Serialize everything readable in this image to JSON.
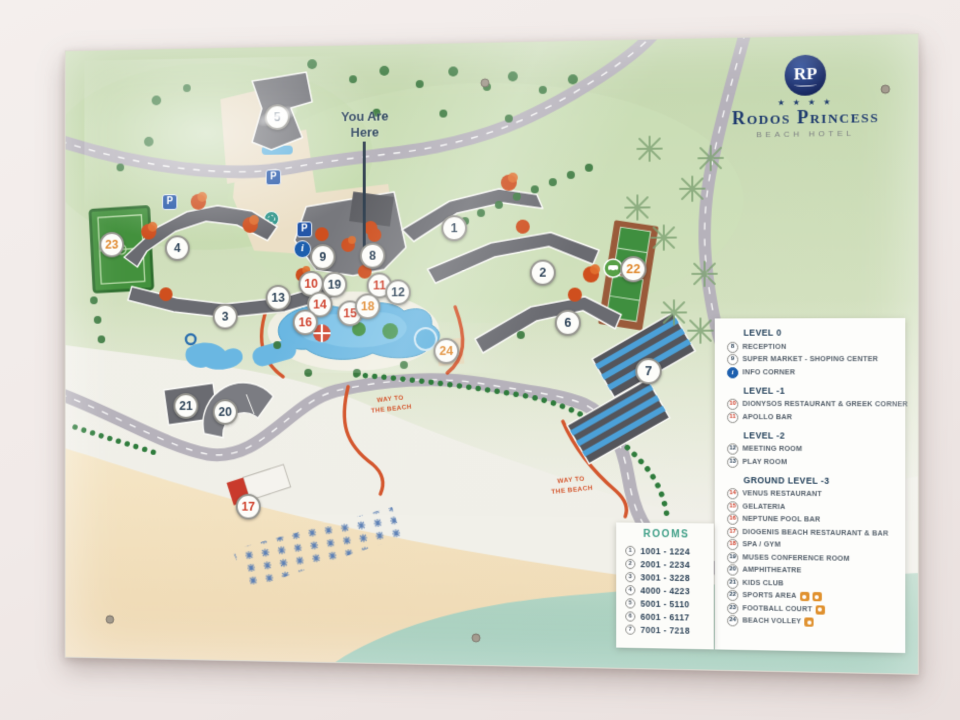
{
  "logo": {
    "monogram": "RP",
    "stars": "★ ★ ★ ★",
    "name": "Rodos Princess",
    "subtitle": "BEACH HOTEL"
  },
  "map": {
    "you_are_here": "You Are\nHere",
    "way_to_beach": "WAY TO\nTHE BEACH",
    "info_symbol": "i",
    "parking_symbol": "P"
  },
  "markers": [
    {
      "n": "1"
    },
    {
      "n": "2"
    },
    {
      "n": "3"
    },
    {
      "n": "4"
    },
    {
      "n": "5"
    },
    {
      "n": "6"
    },
    {
      "n": "7"
    },
    {
      "n": "8"
    },
    {
      "n": "9"
    },
    {
      "n": "10"
    },
    {
      "n": "11"
    },
    {
      "n": "12"
    },
    {
      "n": "13"
    },
    {
      "n": "14"
    },
    {
      "n": "15"
    },
    {
      "n": "16"
    },
    {
      "n": "17"
    },
    {
      "n": "18"
    },
    {
      "n": "19"
    },
    {
      "n": "20"
    },
    {
      "n": "21"
    },
    {
      "n": "22"
    },
    {
      "n": "23"
    },
    {
      "n": "24"
    }
  ],
  "legend": {
    "sections": [
      {
        "title": "LEVEL 0",
        "items": [
          {
            "n": "8",
            "label": "RECEPTION"
          },
          {
            "n": "9",
            "label": "SUPER MARKET - SHOPING CENTER"
          },
          {
            "n": "i",
            "label": "INFO CORNER"
          }
        ]
      },
      {
        "title": "LEVEL -1",
        "items": [
          {
            "n": "10",
            "label": "DIONYSOS RESTAURANT & GREEK CORNER"
          },
          {
            "n": "11",
            "label": "APOLLO BAR"
          }
        ]
      },
      {
        "title": "LEVEL -2",
        "items": [
          {
            "n": "12",
            "label": "MEETING ROOM"
          },
          {
            "n": "13",
            "label": "PLAY ROOM"
          }
        ]
      },
      {
        "title": "GROUND LEVEL -3",
        "items": [
          {
            "n": "14",
            "label": "VENUS RESTAURANT"
          },
          {
            "n": "15",
            "label": "GELATERIA"
          },
          {
            "n": "16",
            "label": "NEPTUNE POOL BAR"
          },
          {
            "n": "17",
            "label": "DIOGENIS BEACH RESTAURANT & BAR"
          },
          {
            "n": "18",
            "label": "SPA / GYM"
          },
          {
            "n": "19",
            "label": "MUSES CONFERENCE ROOM"
          },
          {
            "n": "20",
            "label": "AMPHITHEATRE"
          },
          {
            "n": "21",
            "label": "KIDS CLUB"
          },
          {
            "n": "22",
            "label": "SPORTS AREA"
          },
          {
            "n": "23",
            "label": "FOOTBALL COURT"
          },
          {
            "n": "24",
            "label": "BEACH VOLLEY"
          }
        ]
      }
    ]
  },
  "rooms": {
    "title": "ROOMS",
    "items": [
      {
        "n": "1",
        "range": "1001 - 1224"
      },
      {
        "n": "2",
        "range": "2001 - 2234"
      },
      {
        "n": "3",
        "range": "3001 - 3228"
      },
      {
        "n": "4",
        "range": "4000 - 4223"
      },
      {
        "n": "5",
        "range": "5001 - 5110"
      },
      {
        "n": "6",
        "range": "6001 - 6117"
      },
      {
        "n": "7",
        "range": "7001 - 7218"
      }
    ]
  },
  "colors": {
    "accent_orange": "#d4572e",
    "navy": "#1e3a6e",
    "legend_red": "#cf3f2a",
    "info_blue": "#1d5fae",
    "sea": "#a8cfbd",
    "sand": "#f0dcba"
  }
}
